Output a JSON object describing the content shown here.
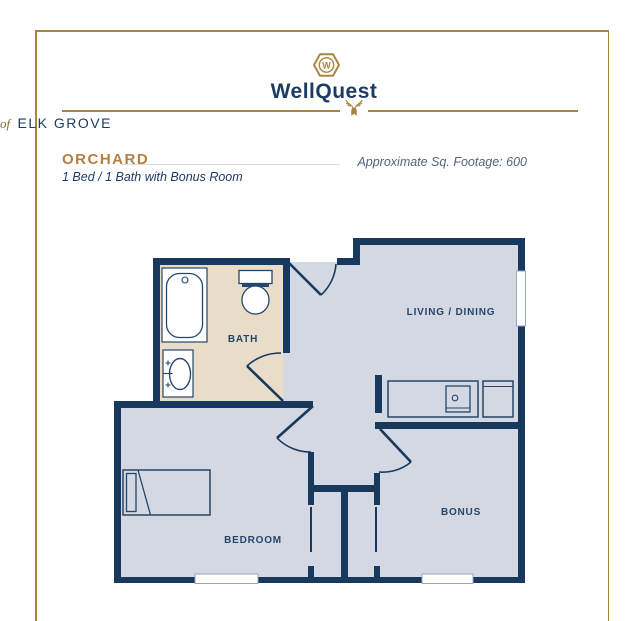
{
  "brand": {
    "monogram": "W",
    "name": "WellQuest",
    "location_prefix": "of",
    "location_name": "ELK GROVE"
  },
  "plan": {
    "name": "ORCHARD",
    "subtitle": "1 Bed / 1 Bath with Bonus Room",
    "footage_note": "Approximate Sq. Footage: 600"
  },
  "rooms": {
    "bath": "BATH",
    "living_dining": "LIVING / DINING",
    "bedroom": "BEDROOM",
    "bonus": "BONUS"
  },
  "colors": {
    "wall_navy": "#17395e",
    "floor_gray": "#d4d8e2",
    "bath_tan": "#e9ddc9",
    "window_trim": "#93a7c0",
    "frame_gold": "#a8853e",
    "accent_gold": "#b5803f"
  }
}
